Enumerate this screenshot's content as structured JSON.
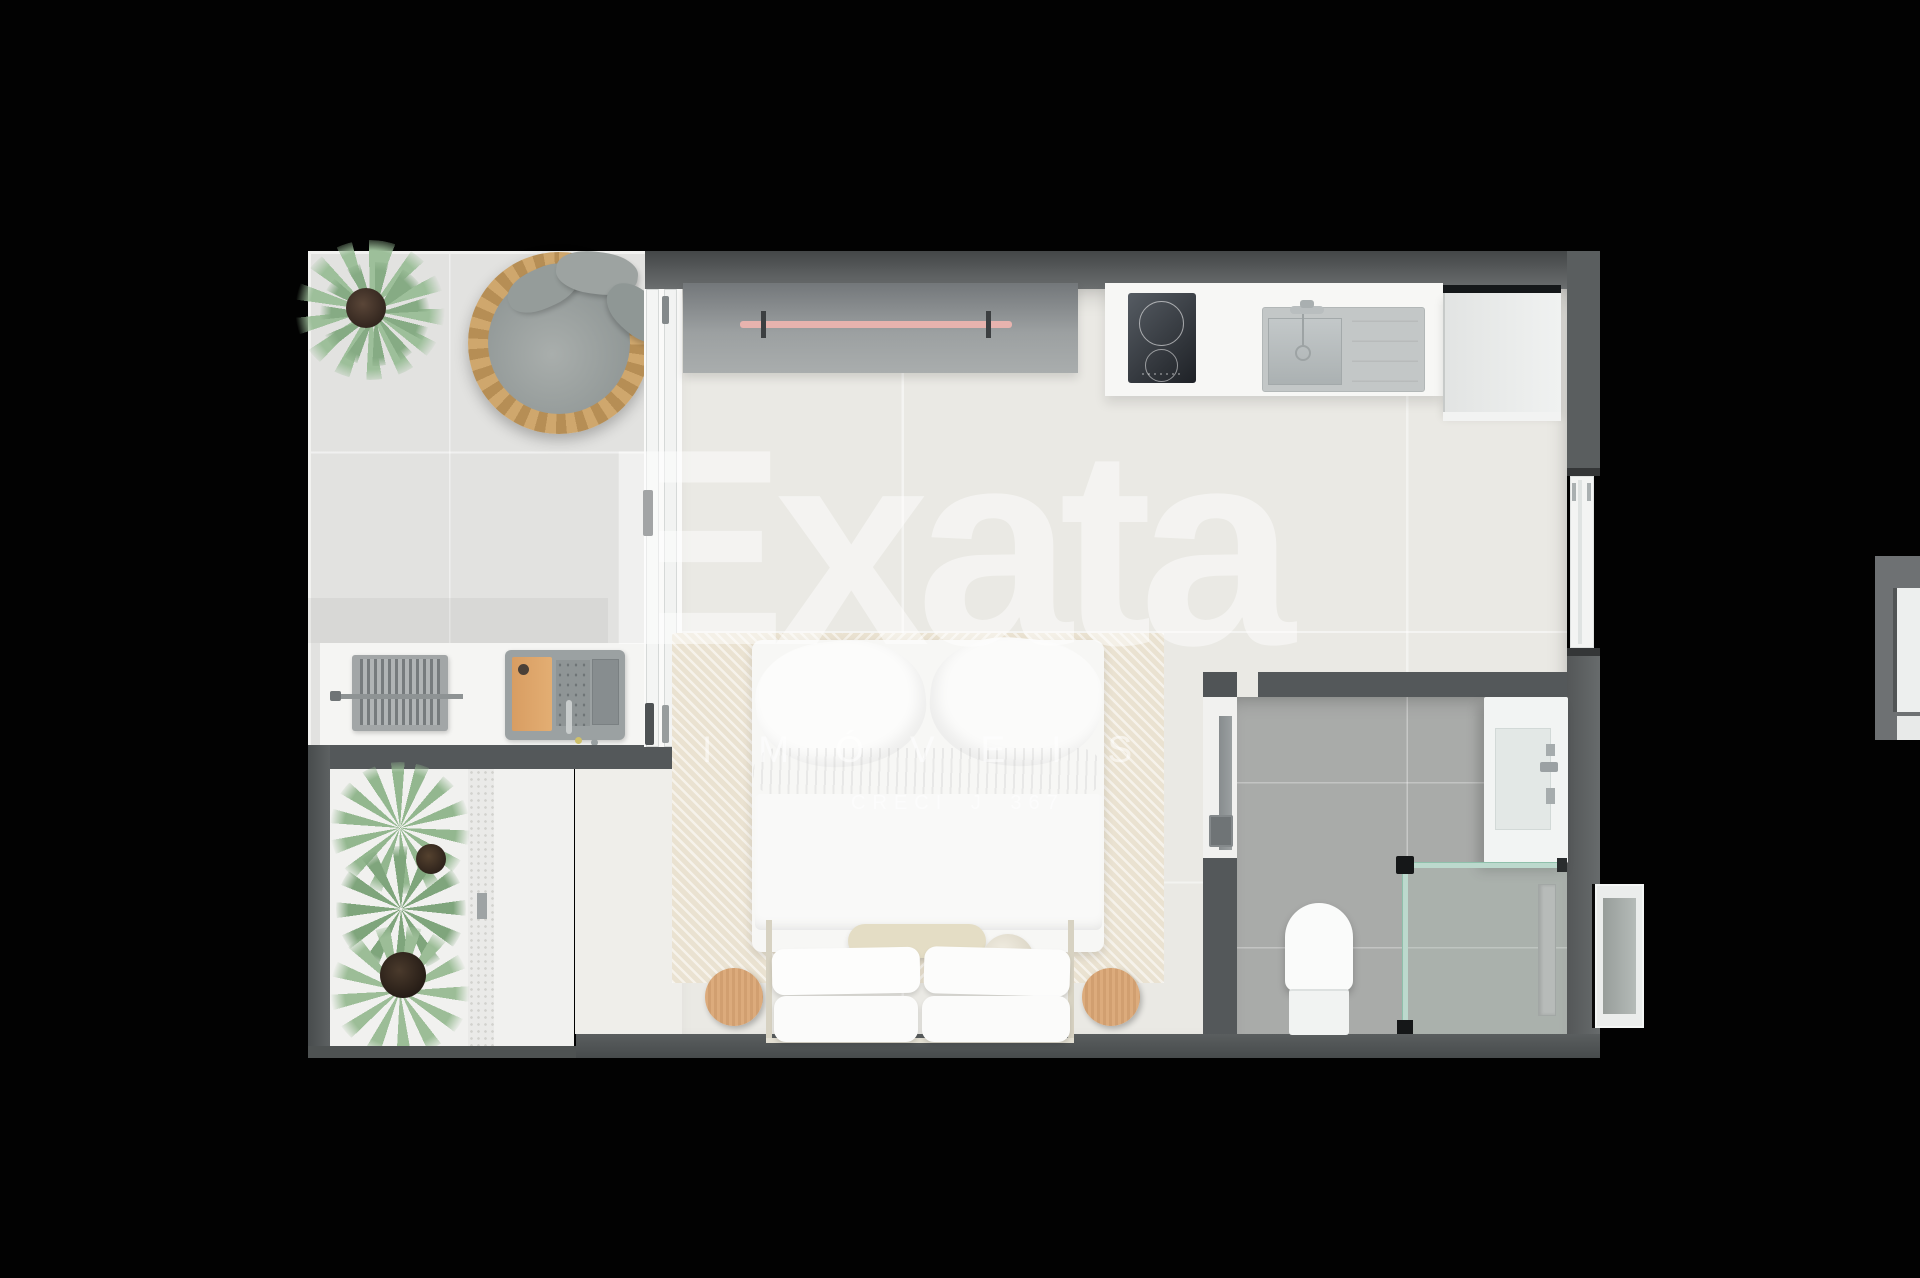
{
  "watermark": {
    "brand": "Exata",
    "subtitle": "IMÓVEIS",
    "license": "CRECI J 367"
  },
  "scene": {
    "type": "3d-top-down-floor-plan-render",
    "unit": "studio-apartment",
    "rooms": [
      "terrace",
      "gourmet-area",
      "winter-garden",
      "bedroom-living",
      "kitchen",
      "bathroom"
    ],
    "furniture": [
      "potted-plant",
      "round-rattan-daybed",
      "barbecue-grill",
      "outdoor-sink-wood-board",
      "sliding-glass-door",
      "wardrobe-rail",
      "induction-cooktop",
      "kitchen-sink",
      "refrigerator-cabinet",
      "area-rug",
      "double-bed",
      "rolled-blanket",
      "bolster-cushion",
      "ball-cushion",
      "pillows",
      "bedside-table-left",
      "bedside-table-right",
      "pocket-door",
      "bathroom-door",
      "toilet",
      "shower-glass-partition",
      "shower-niche",
      "entry-door",
      "garden-plants",
      "pebble-drain-strip",
      "adjacent-unit-fragment",
      "window-right-wall"
    ]
  },
  "colors": {
    "background": "#020202",
    "wall": "#54585a",
    "interior_floor": "#eae9e4",
    "terrace_floor": "#e2e2e0",
    "bathroom_floor": "#a9aba9",
    "rug": "#eae2d1",
    "wood": "#d8a774",
    "rattan": "#cda266",
    "clothes_rail_pink": "#e7b3ae",
    "shower_glass_teal": "#8fc0ab",
    "watermark_white": "#ffffff"
  }
}
